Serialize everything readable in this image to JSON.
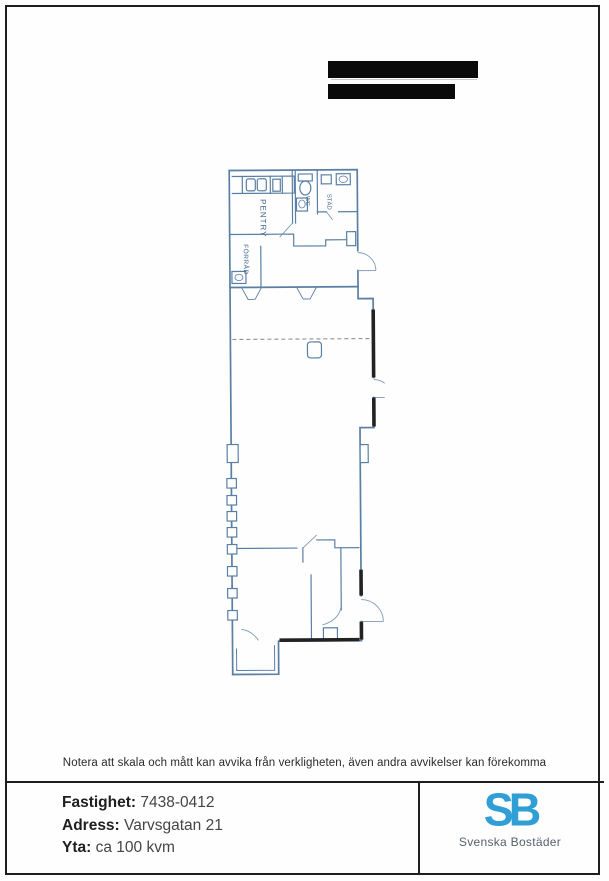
{
  "document": {
    "note": "Notera att skala och mått kan avvika från verkligheten, även andra avvikelser kan förekomma"
  },
  "floor_plan": {
    "rooms": [
      {
        "label": "PENTRY"
      },
      {
        "label": "FÖRRÅD"
      },
      {
        "label": "WC"
      },
      {
        "label": "STÄD"
      }
    ]
  },
  "footer": {
    "fields": [
      {
        "label": "Fastighet:",
        "value": "7438-0412"
      },
      {
        "label": "Adress:",
        "value": "Varvsgatan 21"
      },
      {
        "label": "Yta:",
        "value": "ca 100 kvm"
      }
    ],
    "logo": {
      "monogram": "SB",
      "name": "Svenska Bostäder"
    }
  },
  "colors": {
    "plan_line": "#5a7fa4",
    "wall_dark": "#222222",
    "logo_blue": "#2f9fd6"
  }
}
